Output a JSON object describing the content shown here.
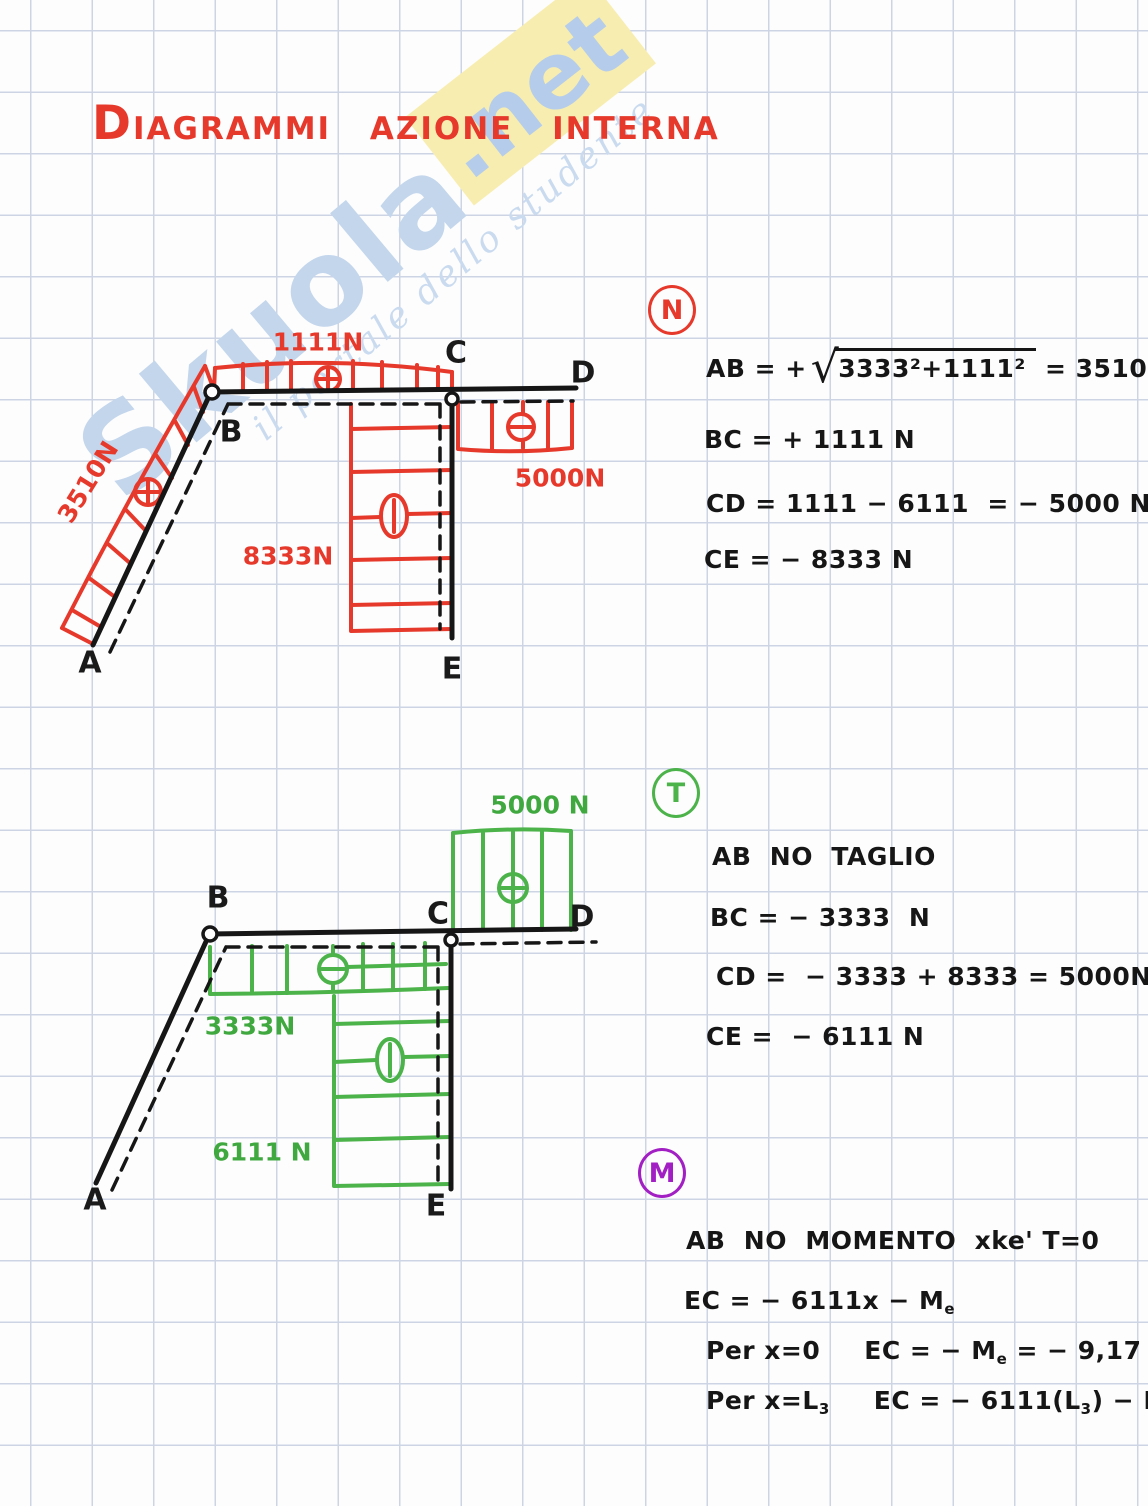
{
  "page": {
    "title": "DIAGRAMMI AZIONE INTERNA"
  },
  "watermark": {
    "brand": "Skuola",
    "suffix": ".net",
    "tagline": "il portale dello studente"
  },
  "diagram_n": {
    "nodes": {
      "a": "A",
      "b": "B",
      "c": "C",
      "d": "D",
      "e": "E"
    },
    "loads": {
      "ab": "3510N",
      "bc": "1111N",
      "cd": "5000N",
      "ce": "8333N"
    },
    "signs": {
      "ab": "+",
      "bc": "+",
      "cd": "−",
      "ce": "−"
    }
  },
  "diagram_t": {
    "nodes": {
      "a": "A",
      "b": "B",
      "c": "C",
      "d": "D",
      "e": "E"
    },
    "loads": {
      "bc": "3333N",
      "cd": "5000 N",
      "ce": "6111 N"
    },
    "signs": {
      "bc": "−",
      "cd": "+",
      "ce": "−"
    }
  },
  "sections": {
    "n": {
      "badge": "N",
      "eq1": {
        "p1": "AB = +",
        "radical": "√",
        "radicand": "3333²+1111²",
        "p2": " = 3510 N"
      },
      "eq2": "BC = + 1111 N",
      "eq3": "CD = 1111 − 6111  = − 5000 N",
      "eq4": "CE = − 8333 N"
    },
    "t": {
      "badge": "T",
      "eq1": "AB  NO  TAGLIO",
      "eq2": "BC = − 3333  N",
      "eq3": "CD =  − 3333 + 8333 = 5000N",
      "eq4": "CE =  − 6111 N"
    },
    "m": {
      "badge": "M",
      "eq1": "AB  NO  MOMENTO  xke' T=0",
      "eq2": {
        "p1": "EC = − 6111x − M",
        "s1": "e"
      },
      "eq3": {
        "label": "Per x=0",
        "p1": "EC = − M",
        "s1": "e",
        "p2": " = − 9,17 kNm"
      },
      "eq4": {
        "label_p1": "Per x=L",
        "ls1": "3",
        "p1": "EC = − 6111(L",
        "s1": "3",
        "p2": ") − M",
        "s2": "e",
        "p3": " = 0"
      }
    }
  },
  "colors": {
    "red": "#e6392b",
    "green": "#4cb34a",
    "purple": "#a21fc4",
    "ink": "#161616",
    "grid": "#cdd5e5",
    "watermark_blue": "#c3d6ec",
    "watermark_yellow": "#f8edb0"
  }
}
